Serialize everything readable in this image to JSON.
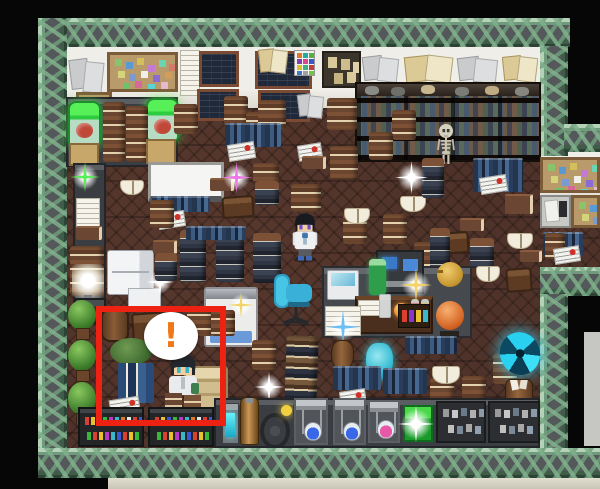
{
  "meta": {
    "scene": "rpg-laboratory-study-room",
    "view": "top-down-tile-map",
    "highlighted_event": "seated character with exclamation bubble"
  },
  "speech_bubble": {
    "exclamation": "!"
  },
  "palette": {
    "frame_green": "#8fb897",
    "panel_gray": "#54585b",
    "floor_brown": "#4f332a",
    "wall_cream": "#efede6",
    "highlight_red": "#ee2213",
    "exclamation_orange": "#f07818",
    "portal_cyan": "#35c8e8",
    "jar_green": "#3ae23a",
    "chair_cyan": "#38b8d8",
    "sparkle_colors": [
      "white",
      "pink",
      "green",
      "gold",
      "blue"
    ]
  },
  "scene": {
    "sprites": [
      {
        "type": "papers-gray",
        "name": "wall-papers-gray",
        "x": 68,
        "y": 56,
        "w": 38,
        "h": 40
      },
      {
        "type": "corkboard",
        "name": "corkboard-large",
        "x": 107,
        "y": 52,
        "w": 71,
        "h": 40
      },
      {
        "type": "corkboard",
        "name": "corkboard-small",
        "x": 76,
        "y": 92,
        "w": 36,
        "h": 44
      },
      {
        "type": "paper-white",
        "name": "wall-note",
        "x": 180,
        "y": 50,
        "w": 20,
        "h": 46
      },
      {
        "type": "blackboard",
        "x": 199,
        "y": 51,
        "w": 40,
        "h": 36
      },
      {
        "type": "blackboard",
        "x": 197,
        "y": 89,
        "w": 42,
        "h": 32
      },
      {
        "type": "blackboard",
        "x": 255,
        "y": 51,
        "w": 57,
        "h": 38
      },
      {
        "type": "papers-tan",
        "x": 258,
        "y": 47,
        "w": 30,
        "h": 28
      },
      {
        "type": "blackboard",
        "x": 258,
        "y": 90,
        "w": 52,
        "h": 32
      },
      {
        "type": "color-chart",
        "x": 294,
        "y": 50,
        "w": 21,
        "h": 26
      },
      {
        "type": "papers-gray",
        "x": 296,
        "y": 92,
        "w": 28,
        "h": 28
      },
      {
        "type": "poster-dark",
        "x": 322,
        "y": 51,
        "w": 39,
        "h": 37
      },
      {
        "type": "papers-gray",
        "x": 361,
        "y": 54,
        "w": 40,
        "h": 31
      },
      {
        "type": "papers-tan",
        "x": 403,
        "y": 53,
        "w": 52,
        "h": 32
      },
      {
        "type": "papers-gray",
        "x": 455,
        "y": 55,
        "w": 45,
        "h": 30
      },
      {
        "type": "papers-tan",
        "x": 502,
        "y": 54,
        "w": 36,
        "h": 30
      },
      {
        "type": "counter",
        "name": "counter-topleft",
        "x": 66,
        "y": 97,
        "w": 112,
        "h": 70
      },
      {
        "type": "specimen-jar",
        "x": 68,
        "y": 101,
        "w": 33,
        "h": 45
      },
      {
        "type": "specimen-jar",
        "x": 146,
        "y": 98,
        "w": 33,
        "h": 43
      },
      {
        "type": "book-stack",
        "x": 103,
        "y": 102,
        "w": 22,
        "h": 60
      },
      {
        "type": "book-stack",
        "x": 126,
        "y": 106,
        "w": 22,
        "h": 56
      },
      {
        "type": "crate",
        "x": 69,
        "y": 143,
        "w": 30,
        "h": 23
      },
      {
        "type": "crate",
        "x": 146,
        "y": 139,
        "w": 30,
        "h": 25
      },
      {
        "type": "bookshelf",
        "name": "wall-bookshelf",
        "x": 355,
        "y": 82,
        "w": 186,
        "h": 80
      },
      {
        "type": "skeleton",
        "name": "skeleton",
        "x": 433,
        "y": 123,
        "w": 26,
        "h": 42
      },
      {
        "type": "corkboard",
        "name": "alcove-corkboard",
        "x": 540,
        "y": 157,
        "w": 60,
        "h": 36
      },
      {
        "type": "desk-papers",
        "x": 540,
        "y": 195,
        "w": 31,
        "h": 33
      },
      {
        "type": "corkboard",
        "name": "alcove-corkboard-2",
        "x": 571,
        "y": 195,
        "w": 29,
        "h": 33
      },
      {
        "type": "books-row-blue",
        "x": 543,
        "y": 232,
        "w": 40,
        "h": 24
      },
      {
        "type": "book-stack",
        "x": 545,
        "y": 233,
        "w": 20,
        "h": 26
      },
      {
        "type": "newspaper",
        "x": 554,
        "y": 247,
        "w": 26,
        "h": 16
      },
      {
        "type": "screen-white",
        "name": "projector-screen",
        "x": 148,
        "y": 162,
        "w": 76,
        "h": 40
      },
      {
        "type": "books-row-blue",
        "x": 152,
        "y": 196,
        "w": 58,
        "h": 16
      },
      {
        "type": "counter",
        "name": "counter-left",
        "x": 73,
        "y": 163,
        "w": 33,
        "h": 150
      },
      {
        "type": "sparkle",
        "color": "green",
        "x": 70,
        "y": 162,
        "w": 30,
        "h": 30
      },
      {
        "type": "paper-white",
        "x": 76,
        "y": 198,
        "w": 24,
        "h": 30
      },
      {
        "type": "book-flat",
        "x": 76,
        "y": 226,
        "w": 26,
        "h": 14
      },
      {
        "type": "book-stack",
        "x": 70,
        "y": 246,
        "w": 34,
        "h": 50
      },
      {
        "type": "lamp-glow",
        "x": 72,
        "y": 264,
        "w": 32,
        "h": 42
      },
      {
        "type": "machine-dark",
        "x": 74,
        "y": 298,
        "w": 32,
        "h": 26
      },
      {
        "type": "tree-bush",
        "x": 66,
        "y": 300,
        "w": 32,
        "h": 40
      },
      {
        "type": "tree-bush",
        "x": 66,
        "y": 340,
        "w": 32,
        "h": 42
      },
      {
        "type": "tree-bush",
        "x": 66,
        "y": 382,
        "w": 32,
        "h": 44
      },
      {
        "type": "fridge",
        "x": 107,
        "y": 250,
        "w": 47,
        "h": 45
      },
      {
        "type": "white-box",
        "x": 128,
        "y": 288,
        "w": 33,
        "h": 22
      },
      {
        "type": "sparkle",
        "color": "white",
        "x": 146,
        "y": 268,
        "w": 28,
        "h": 28
      },
      {
        "type": "table-brown",
        "x": 222,
        "y": 196,
        "w": 32,
        "h": 22
      },
      {
        "type": "table-brown",
        "x": 435,
        "y": 232,
        "w": 34,
        "h": 22
      },
      {
        "type": "table-brown",
        "x": 506,
        "y": 268,
        "w": 26,
        "h": 24
      },
      {
        "type": "bed",
        "name": "bed",
        "x": 204,
        "y": 287,
        "w": 54,
        "h": 60
      },
      {
        "type": "sparkle",
        "color": "gold",
        "x": 228,
        "y": 292,
        "w": 26,
        "h": 26
      },
      {
        "type": "book-stack",
        "x": 174,
        "y": 104,
        "w": 24,
        "h": 30
      },
      {
        "type": "book-stack",
        "x": 224,
        "y": 96,
        "w": 24,
        "h": 30
      },
      {
        "type": "book-stack",
        "x": 246,
        "y": 112,
        "w": 24,
        "h": 28
      },
      {
        "type": "book-stack",
        "x": 258,
        "y": 100,
        "w": 28,
        "h": 30
      },
      {
        "type": "book-stack",
        "x": 327,
        "y": 98,
        "w": 30,
        "h": 32
      },
      {
        "type": "book-stack",
        "x": 392,
        "y": 110,
        "w": 24,
        "h": 30
      },
      {
        "type": "book-stack",
        "x": 369,
        "y": 132,
        "w": 24,
        "h": 28
      },
      {
        "type": "book-stack",
        "x": 330,
        "y": 146,
        "w": 28,
        "h": 34
      },
      {
        "type": "books-row-blue",
        "x": 225,
        "y": 123,
        "w": 56,
        "h": 24
      },
      {
        "type": "newspaper",
        "x": 228,
        "y": 143,
        "w": 27,
        "h": 17
      },
      {
        "type": "newspaper",
        "x": 298,
        "y": 144,
        "w": 24,
        "h": 16
      },
      {
        "type": "book-stack",
        "x": 253,
        "y": 163,
        "w": 26,
        "h": 20
      },
      {
        "type": "book-stack-dark",
        "x": 255,
        "y": 181,
        "w": 24,
        "h": 24
      },
      {
        "type": "book-flat",
        "x": 210,
        "y": 178,
        "w": 24,
        "h": 13
      },
      {
        "type": "book-flat",
        "x": 302,
        "y": 156,
        "w": 24,
        "h": 13
      },
      {
        "type": "newspaper",
        "x": 158,
        "y": 212,
        "w": 27,
        "h": 16
      },
      {
        "type": "book-flat",
        "x": 153,
        "y": 240,
        "w": 24,
        "h": 14
      },
      {
        "type": "book-stack-dark",
        "x": 155,
        "y": 253,
        "w": 22,
        "h": 28
      },
      {
        "type": "book-stack",
        "x": 150,
        "y": 200,
        "w": 24,
        "h": 28
      },
      {
        "type": "book-stack-dark",
        "x": 180,
        "y": 230,
        "w": 26,
        "h": 52
      },
      {
        "type": "book-stack-dark",
        "x": 216,
        "y": 228,
        "w": 28,
        "h": 54
      },
      {
        "type": "book-stack-dark",
        "x": 253,
        "y": 233,
        "w": 28,
        "h": 50
      },
      {
        "type": "books-row-blue",
        "x": 186,
        "y": 226,
        "w": 60,
        "h": 14
      },
      {
        "type": "book-stack",
        "x": 343,
        "y": 214,
        "w": 24,
        "h": 30
      },
      {
        "type": "book-stack",
        "x": 383,
        "y": 214,
        "w": 24,
        "h": 30
      },
      {
        "type": "book-stack",
        "x": 414,
        "y": 242,
        "w": 24,
        "h": 30
      },
      {
        "type": "open-book",
        "x": 400,
        "y": 196,
        "w": 26,
        "h": 16
      },
      {
        "type": "open-book",
        "x": 344,
        "y": 208,
        "w": 26,
        "h": 16
      },
      {
        "type": "open-book",
        "x": 120,
        "y": 180,
        "w": 24,
        "h": 15
      },
      {
        "type": "book-stack-dark",
        "x": 422,
        "y": 158,
        "w": 22,
        "h": 40
      },
      {
        "type": "books-row-blue",
        "x": 473,
        "y": 158,
        "w": 50,
        "h": 34
      },
      {
        "type": "newspaper",
        "x": 480,
        "y": 176,
        "w": 27,
        "h": 17
      },
      {
        "type": "book-flat",
        "x": 460,
        "y": 218,
        "w": 24,
        "h": 13
      },
      {
        "type": "book-stack-dark",
        "x": 430,
        "y": 228,
        "w": 20,
        "h": 40
      },
      {
        "type": "book-stack-dark",
        "x": 470,
        "y": 238,
        "w": 24,
        "h": 30
      },
      {
        "type": "open-book",
        "x": 507,
        "y": 233,
        "w": 26,
        "h": 16
      },
      {
        "type": "book-flat",
        "x": 505,
        "y": 194,
        "w": 28,
        "h": 20
      },
      {
        "type": "book-flat",
        "x": 520,
        "y": 250,
        "w": 22,
        "h": 12
      },
      {
        "type": "platform",
        "name": "big-table",
        "x": 322,
        "y": 266,
        "w": 150,
        "h": 72
      },
      {
        "type": "computer-desk",
        "name": "computer-desk",
        "x": 376,
        "y": 250,
        "w": 48,
        "h": 44
      },
      {
        "type": "laptop",
        "x": 327,
        "y": 270,
        "w": 32,
        "h": 30
      },
      {
        "type": "bottle-green",
        "x": 369,
        "y": 259,
        "w": 17,
        "h": 36
      },
      {
        "type": "desk-wood",
        "x": 355,
        "y": 296,
        "w": 78,
        "h": 38
      },
      {
        "type": "paper-white",
        "x": 358,
        "y": 300,
        "w": 22,
        "h": 16
      },
      {
        "type": "glass",
        "x": 379,
        "y": 294,
        "w": 12,
        "h": 24
      },
      {
        "type": "orb-orange",
        "x": 394,
        "y": 303,
        "w": 15,
        "h": 15
      },
      {
        "type": "bottle-red",
        "x": 411,
        "y": 299,
        "w": 8,
        "h": 18
      },
      {
        "type": "bottle-yellow",
        "x": 421,
        "y": 299,
        "w": 8,
        "h": 18
      },
      {
        "type": "kettle",
        "x": 437,
        "y": 262,
        "w": 26,
        "h": 25
      },
      {
        "type": "pot-orange",
        "x": 432,
        "y": 298,
        "w": 35,
        "h": 40
      },
      {
        "type": "potion-row",
        "x": 398,
        "y": 304,
        "w": 32,
        "h": 24
      },
      {
        "type": "sparkle",
        "color": "gold",
        "x": 400,
        "y": 268,
        "w": 32,
        "h": 34
      },
      {
        "type": "paper-white",
        "x": 325,
        "y": 306,
        "w": 36,
        "h": 30
      },
      {
        "type": "sparkle",
        "color": "blue",
        "x": 326,
        "y": 310,
        "w": 34,
        "h": 34
      },
      {
        "type": "office-chair",
        "name": "office-chair",
        "x": 272,
        "y": 272,
        "w": 44,
        "h": 54
      },
      {
        "type": "book-stack",
        "x": 291,
        "y": 184,
        "w": 30,
        "h": 28
      },
      {
        "type": "scientist",
        "name": "scientist-character",
        "x": 288,
        "y": 211,
        "w": 34,
        "h": 52,
        "interactable": true
      },
      {
        "type": "urn-brown",
        "x": 331,
        "y": 340,
        "w": 23,
        "h": 30
      },
      {
        "type": "vase-cyan",
        "x": 366,
        "y": 343,
        "w": 27,
        "h": 37
      },
      {
        "type": "book-tower",
        "x": 285,
        "y": 336,
        "w": 32,
        "h": 102
      },
      {
        "type": "books-row-blue",
        "x": 333,
        "y": 366,
        "w": 48,
        "h": 24
      },
      {
        "type": "books-row-blue",
        "x": 383,
        "y": 368,
        "w": 44,
        "h": 26
      },
      {
        "type": "books-row-blue",
        "x": 405,
        "y": 336,
        "w": 52,
        "h": 18
      },
      {
        "type": "newspaper",
        "x": 340,
        "y": 390,
        "w": 26,
        "h": 16
      },
      {
        "type": "sparkle",
        "color": "white",
        "x": 254,
        "y": 372,
        "w": 30,
        "h": 30
      },
      {
        "type": "book-stack",
        "x": 252,
        "y": 340,
        "w": 24,
        "h": 30
      },
      {
        "type": "book-stack",
        "x": 430,
        "y": 378,
        "w": 24,
        "h": 30
      },
      {
        "type": "book-stack",
        "x": 462,
        "y": 376,
        "w": 24,
        "h": 30
      },
      {
        "type": "book-stack",
        "x": 493,
        "y": 354,
        "w": 24,
        "h": 30
      },
      {
        "type": "open-book",
        "x": 432,
        "y": 366,
        "w": 28,
        "h": 18
      },
      {
        "type": "open-book",
        "x": 476,
        "y": 266,
        "w": 24,
        "h": 16
      },
      {
        "type": "portal",
        "name": "portal",
        "x": 500,
        "y": 332,
        "w": 40,
        "h": 43,
        "interactable": true
      },
      {
        "type": "urn-papers",
        "x": 505,
        "y": 379,
        "w": 28,
        "h": 38
      },
      {
        "type": "barrel",
        "x": 101,
        "y": 308,
        "w": 28,
        "h": 34
      },
      {
        "type": "table-brown",
        "x": 132,
        "y": 312,
        "w": 48,
        "h": 30
      },
      {
        "type": "table-green",
        "x": 108,
        "y": 336,
        "w": 46,
        "h": 42
      },
      {
        "type": "book-stack",
        "x": 187,
        "y": 306,
        "w": 26,
        "h": 30
      },
      {
        "type": "book-stack",
        "x": 211,
        "y": 310,
        "w": 24,
        "h": 26
      },
      {
        "type": "desk-tan",
        "x": 184,
        "y": 366,
        "w": 44,
        "h": 54
      },
      {
        "type": "book-stand-blue",
        "x": 118,
        "y": 363,
        "w": 36,
        "h": 40
      },
      {
        "type": "newspaper",
        "x": 110,
        "y": 398,
        "w": 30,
        "h": 20
      },
      {
        "type": "seated-char",
        "name": "highlighted-character",
        "x": 160,
        "y": 352,
        "w": 46,
        "h": 64,
        "interactable": true
      },
      {
        "type": "speech-bubble",
        "name": "speech-bubble",
        "x": 144,
        "y": 312,
        "w": 54,
        "h": 48,
        "interactable": true
      },
      {
        "type": "counter",
        "name": "lab-counter",
        "x": 214,
        "y": 398,
        "w": 326,
        "h": 50
      },
      {
        "type": "potion-cabinet",
        "x": 78,
        "y": 407,
        "w": 66,
        "h": 40
      },
      {
        "type": "potion-cabinet",
        "x": 148,
        "y": 407,
        "w": 66,
        "h": 40
      },
      {
        "type": "device-cyan",
        "x": 222,
        "y": 403,
        "w": 17,
        "h": 41
      },
      {
        "type": "tank-brass",
        "x": 240,
        "y": 397,
        "w": 19,
        "h": 48
      },
      {
        "type": "wheel-device",
        "x": 258,
        "y": 401,
        "w": 35,
        "h": 45
      },
      {
        "type": "alchemy-station",
        "color": "blue",
        "x": 294,
        "y": 398,
        "w": 34,
        "h": 47
      },
      {
        "type": "alchemy-station",
        "color": "blue",
        "x": 333,
        "y": 398,
        "w": 33,
        "h": 47
      },
      {
        "type": "alchemy-station",
        "color": "pink",
        "x": 368,
        "y": 400,
        "w": 32,
        "h": 43
      },
      {
        "type": "green-box",
        "x": 403,
        "y": 405,
        "w": 30,
        "h": 37
      },
      {
        "type": "sparkle",
        "color": "white",
        "x": 398,
        "y": 406,
        "w": 36,
        "h": 36
      },
      {
        "type": "shelf-gray",
        "x": 436,
        "y": 401,
        "w": 50,
        "h": 42
      },
      {
        "type": "shelf-gray",
        "x": 488,
        "y": 401,
        "w": 52,
        "h": 42
      },
      {
        "type": "sparkle",
        "color": "pink",
        "x": 221,
        "y": 162,
        "w": 31,
        "h": 31
      },
      {
        "type": "sparkle",
        "color": "white",
        "x": 395,
        "y": 161,
        "w": 33,
        "h": 33
      }
    ],
    "highlight": {
      "x": 96,
      "y": 306,
      "w": 130,
      "h": 120
    }
  }
}
